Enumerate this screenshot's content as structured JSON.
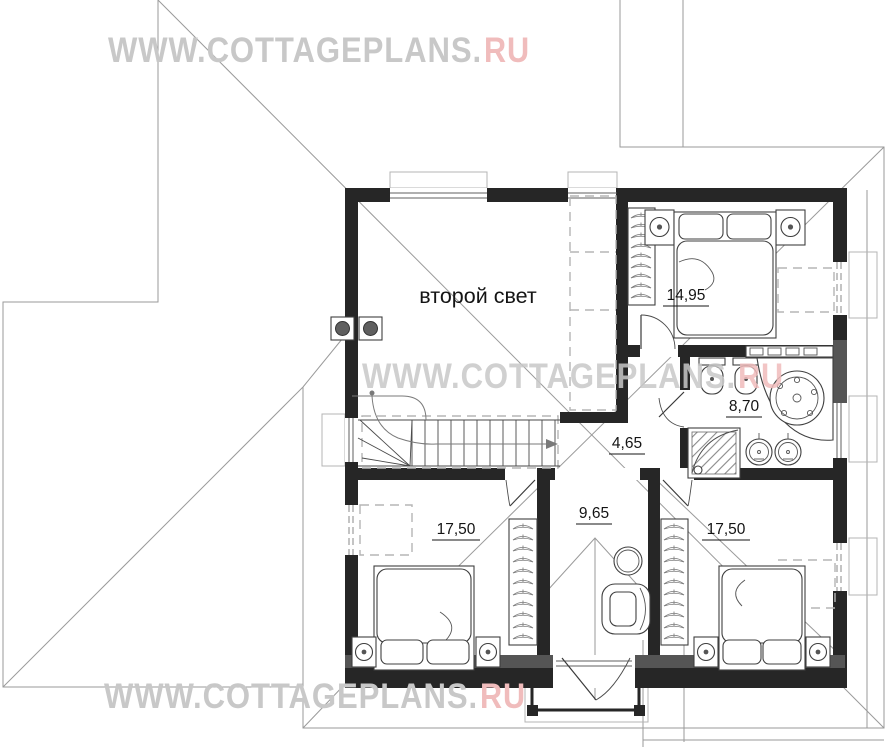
{
  "title": "Cottage second floor plan",
  "watermark": {
    "main": "WWW.COTTAGEPLANS.",
    "suffix": "RU",
    "color_main": "#c8c8c8",
    "color_suffix": "#f0bcbc"
  },
  "rooms": {
    "second_light": {
      "label": "второй свет"
    },
    "bedroom_top": {
      "area": "14,95"
    },
    "bathroom": {
      "area": "8,70"
    },
    "hall": {
      "area": "4,65"
    },
    "study": {
      "area": "9,65"
    },
    "bedroom_left": {
      "area": "17,50"
    },
    "bedroom_right": {
      "area": "17,50"
    }
  },
  "colors": {
    "wall": "#262626",
    "roof_line": "#9a9a9a",
    "label": "#141414"
  }
}
